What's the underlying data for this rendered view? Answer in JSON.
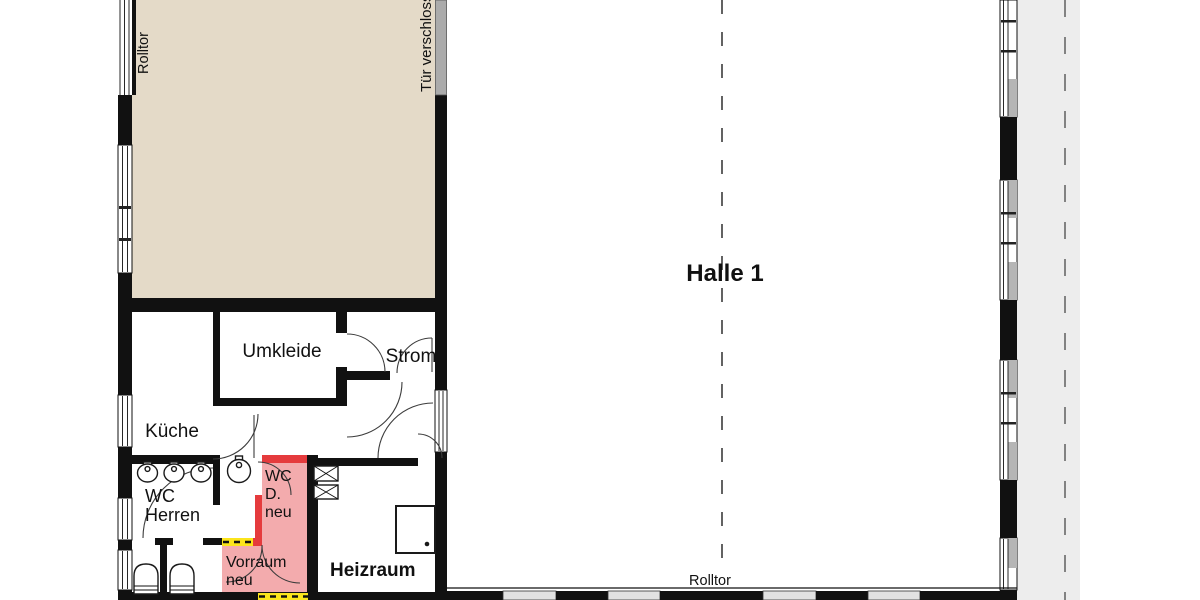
{
  "floor_plan": {
    "labels": {
      "hall": "Halle 1",
      "roller_door_left": "Rolltor",
      "roller_door_bottom": "Rolltor",
      "locked_door": "Tür verschlossen",
      "changing_room": "Umkleide",
      "electrical_room": "Strom",
      "kitchen": "Küche",
      "wc_men": [
        "WC",
        "Herren"
      ],
      "wc_women_new": [
        "WC",
        "D.",
        "neu"
      ],
      "anteroom_new": [
        "Vorraum",
        "neu"
      ],
      "boiler_room": "Heizraum"
    },
    "colors": {
      "annex_hall_floor_beige": "#e4dac8",
      "new_room_pink": "#f3abad",
      "new_wall_red": "#e53b3d",
      "new_wall_yellow": "#fce51c",
      "locked_door_gray": "#ababab",
      "outside_strip_gray": "#ededed",
      "wall_black": "#111111",
      "reference_dash_gray": "#3c3c3c"
    },
    "icons": {
      "door_swing": "quarter-arc",
      "window": "double-line-in-wall",
      "roller_door": "parallel-lines",
      "washbasin": "oval",
      "toilet": "round-top-rect",
      "electrical_box": "crossed-square",
      "boiler": "square-with-drain-dot"
    }
  }
}
